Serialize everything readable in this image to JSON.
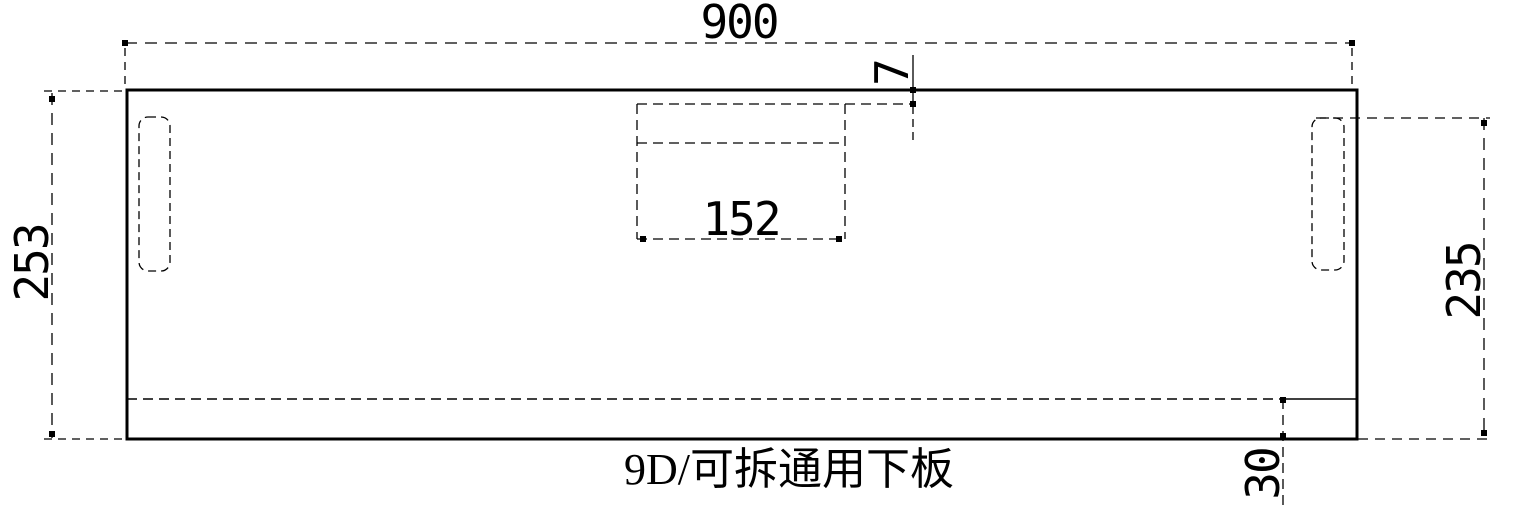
{
  "drawing": {
    "title": "9D/可拆通用下板",
    "dimensions": {
      "overall_width": "900",
      "left_height": "253",
      "right_height": "235",
      "cutout_width": "152",
      "cutout_top_offset": "7",
      "bottom_strip_height": "30"
    }
  },
  "colors": {
    "line": "#000000",
    "background": "#ffffff"
  }
}
